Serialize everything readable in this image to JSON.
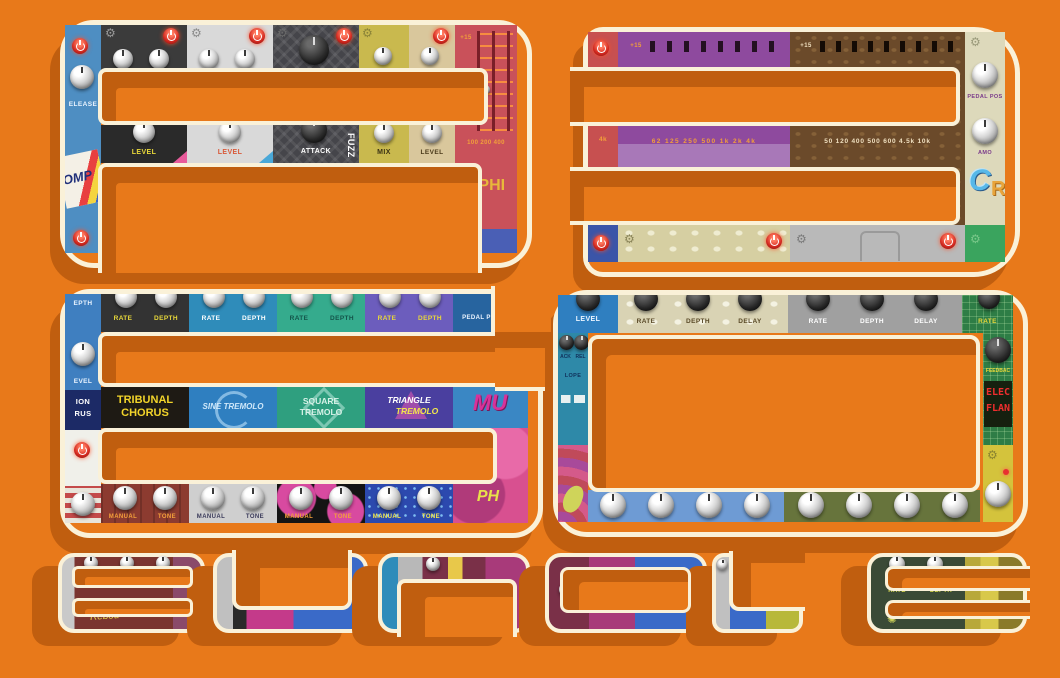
{
  "palette": {
    "background": "#E8791A",
    "shadow": "#C05E0F",
    "outline": "#FAF1D8"
  },
  "icons": {
    "gear": "⚙",
    "sun": "✺"
  },
  "artwork": {
    "glyph_letters": [
      "A",
      "3",
      "6",
      "0"
    ],
    "word": "BUNDLE"
  },
  "glyph_a": {
    "left": {
      "release": "ELEASE",
      "sticker": "OMP"
    },
    "labels": {
      "level1": "LEVEL",
      "level2": "LEVEL",
      "attack": "ATTACK",
      "fuzz": "FUZZ",
      "mix": "MIX",
      "level3": "LEVEL"
    },
    "eq": {
      "plus": "+15",
      "freqs": "100 200 400",
      "brand": "ΔPHI"
    }
  },
  "glyph_3": {
    "left": {
      "k4": "4k"
    },
    "purple_eq": {
      "plus": "+15",
      "freqs": "62 125 250 500 1k 2k 4k"
    },
    "brown_eq": {
      "plus": "+15",
      "freqs": "50 120 400 500 600 4.5k 10k"
    },
    "right": {
      "pedal_pos": "PEDAL POS",
      "amount": "AMO",
      "logo": "C",
      "logo2": "R"
    }
  },
  "glyph_6": {
    "left": {
      "depth": "EPTH",
      "level": "EVEL",
      "line1": "ION",
      "line2": "RUS"
    },
    "top": [
      {
        "rate": "RATE",
        "depth": "DEPTH"
      },
      {
        "rate": "RATE",
        "depth": "DEPTH"
      },
      {
        "rate": "RATE",
        "depth": "DEPTH"
      },
      {
        "rate": "RATE",
        "depth": "DEPTH"
      }
    ],
    "pedal_pos": "PEDAL PO",
    "names": {
      "n1a": "TRIBUNAL",
      "n1b": "CHORUS",
      "n2": "SINE TREMOLO",
      "n3a": "SQUARE",
      "n3b": "TREMOLO",
      "n4a": "TRIANGLE",
      "n4b": "TREMOLO",
      "mu": "MU"
    },
    "bottom": [
      {
        "manual": "MANUAL",
        "tone": "TONE"
      },
      {
        "manual": "MANUAL",
        "tone": "TONE"
      },
      {
        "manual": "MANUAL",
        "tone": "TONE"
      },
      {
        "manual": "MANUAL",
        "tone": "TONE"
      }
    ],
    "ph": "PH"
  },
  "glyph_0": {
    "top": {
      "level": "LEVEL",
      "c1": [
        "RATE",
        "DEPTH",
        "DELAY"
      ],
      "c2": [
        "RATE",
        "DEPTH",
        "DELAY"
      ],
      "rate": "RATE"
    },
    "left": {
      "ack": "ACK",
      "rel": "REL",
      "lope": "LOPE"
    },
    "right": {
      "feedback": "FEEDBAC",
      "elec": "ELEC",
      "flan": "FLAN"
    }
  },
  "bundle": {
    "b_script": "Rebou",
    "e_rate": "RATE",
    "e_depth": "DEPTH"
  }
}
